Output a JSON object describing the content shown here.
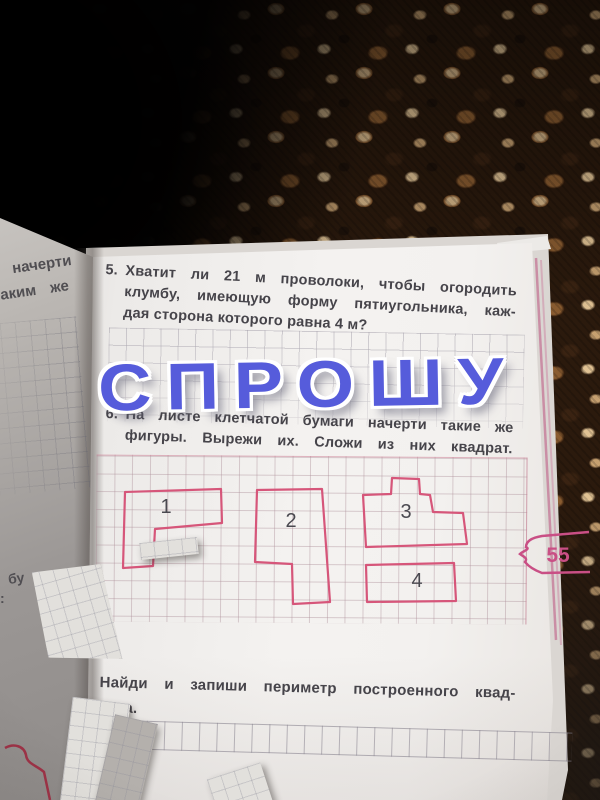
{
  "watermark": {
    "text": "СПРОШУ",
    "color": "#565cdb"
  },
  "page": {
    "number_badge": "55",
    "problem5": {
      "number": "5.",
      "line1": "Хватит ли 21 м проволоки, чтобы огородить",
      "line2": "клумбу, имеющую форму пятиугольника, каж-",
      "line3": "дая сторона которого равна 4 м?"
    },
    "problem6": {
      "number": "6.",
      "line1": "На листе клетчатой бумаги начерти такие же",
      "line2": "фигуры. Вырежи их. Сложи из них квадрат."
    },
    "task_bottom": {
      "line1": "Найди и запиши периметр построенного квад-",
      "line2": "рата."
    },
    "figure_color": "#d6567a",
    "label_color": "#4a4950",
    "badge_color": "#c94f85",
    "figures": [
      {
        "label": "1",
        "points": "125,492 221,489 222,523 155,529 153,566 123,568",
        "label_x": 166,
        "label_y": 513
      },
      {
        "label": "2",
        "points": "257,490 322,489 330,602 293,604 292,564 255,562",
        "label_x": 291,
        "label_y": 527
      },
      {
        "label": "3",
        "points": "392,478 419,479 420,494 430,495 433,512 463,513 467,544 366,547 363,495 391,494",
        "label_x": 406,
        "label_y": 518
      },
      {
        "label": "4",
        "points": "366,565 454,563 456,601 367,602",
        "label_x": 417,
        "label_y": 587
      }
    ]
  },
  "left_page": {
    "fragment1": "начерти",
    "fragment2": "аким  же",
    "fragment3": "бу",
    "fragment4": ":"
  }
}
